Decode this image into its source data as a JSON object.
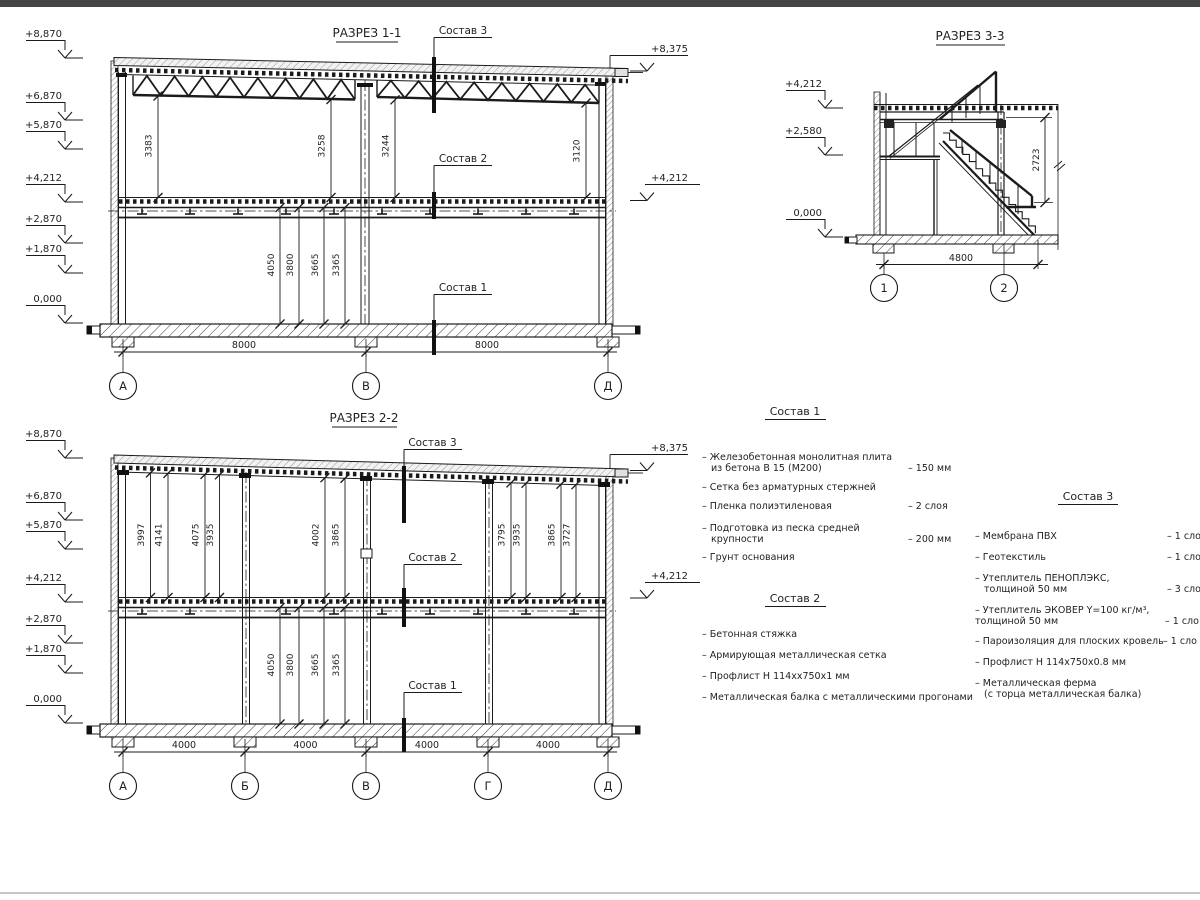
{
  "callouts": {
    "sostav1": "Состав 1",
    "sostav2": "Состав 2",
    "sostav3": "Состав 3"
  },
  "elevations_left": [
    "+8,870",
    "+6,870",
    "+5,870",
    "+4,212",
    "+2,870",
    "+1,870",
    "0,000"
  ],
  "section11": {
    "title": "РАЗРЕЗ 1-1",
    "elev_roof": "+8,375",
    "elev_floor": "+4,212",
    "dims_upper": [
      "3383",
      "3258",
      "3244",
      "3120"
    ],
    "dims_lower": [
      "4050",
      "3800",
      "3665",
      "3365"
    ],
    "dims_span": [
      "8000",
      "8000"
    ],
    "axes": [
      "А",
      "В",
      "Д"
    ]
  },
  "section22": {
    "title": "РАЗРЕЗ 2-2",
    "elev_roof": "+8,375",
    "elev_floor": "+4,212",
    "dims_upper": [
      "3997",
      "4141",
      "4075",
      "3935",
      "4002",
      "3865",
      "3795",
      "3935",
      "3865",
      "3727"
    ],
    "dims_lower": [
      "4050",
      "3800",
      "3665",
      "3365"
    ],
    "dims_span": [
      "4000",
      "4000",
      "4000",
      "4000"
    ],
    "axes": [
      "А",
      "Б",
      "В",
      "Г",
      "Д"
    ]
  },
  "section33": {
    "title": "РАЗРЕЗ 3-3",
    "elevations": [
      "+4,212",
      "+2,580",
      "0,000"
    ],
    "dim_height": "2723",
    "dim_span": "4800",
    "axes": [
      "1",
      "2"
    ]
  },
  "sostav1": {
    "title": "Состав 1",
    "items": [
      {
        "line1": "– Железобетонная  монолитная плита",
        "line2": "из бетона В 15 (М200)",
        "value": "– 150 мм"
      },
      {
        "line1": "– Сетка без арматурных стержней",
        "line2": "",
        "value": ""
      },
      {
        "line1": "– Пленка полиэтиленовая",
        "line2": "",
        "value": "– 2 слоя"
      },
      {
        "line1": "– Подготовка из песка средней",
        "line2": "крупности",
        "value": "– 200 мм"
      },
      {
        "line1": "– Грунт основания",
        "line2": "",
        "value": ""
      }
    ]
  },
  "sostav2": {
    "title": "Состав 2",
    "items": [
      {
        "line1": "– Бетонная стяжка"
      },
      {
        "line1": "– Армирующая металлическая сетка"
      },
      {
        "line1": "– Профлист Н 114хх750х1 мм"
      },
      {
        "line1": "– Металлическая балка с металлическими прогонами"
      }
    ]
  },
  "sostav3": {
    "title": "Состав 3",
    "items": [
      {
        "line1": "– Мембрана ПВХ",
        "line2": "",
        "value": "– 1 сло"
      },
      {
        "line1": "– Геотекстиль",
        "line2": "",
        "value": "– 1 сло"
      },
      {
        "line1": "– Утеплитель ПЕНОПЛЭКС,",
        "line2": "толщиной 50 мм",
        "value": "– 3 сло"
      },
      {
        "line1": "– Утеплитель ЭКОВЕР Y=100 кг/м³,",
        "line2": "толщиной 50 мм",
        "value": "– 1 сло"
      },
      {
        "line1": "– Пароизоляция для плоских кровель",
        "line2": "",
        "value": "– 1 сло"
      },
      {
        "line1": "– Профлист Н 114х750х0.8 мм",
        "line2": ""
      },
      {
        "line1": "– Металлическая ферма",
        "line2": "(с торца металлическая балка)"
      }
    ]
  }
}
